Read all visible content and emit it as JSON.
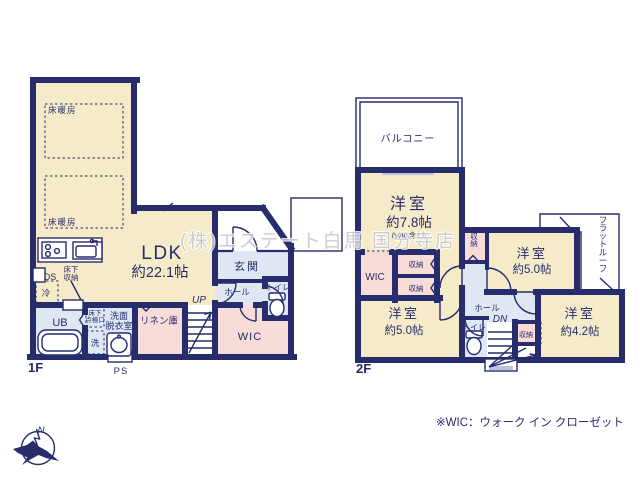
{
  "plan": {
    "floor1": {
      "floor_label": "1F",
      "ldk": {
        "name": "LDK",
        "size": "約22.1帖"
      },
      "floor_heating": "床暖房",
      "kitchen": {
        "ds": "DS",
        "underfloor_storage_l1": "床下",
        "underfloor_storage_l2": "収納",
        "fridge": "冷"
      },
      "bath": {
        "ub": "UB",
        "washer": "洗",
        "inspection_l1": "床下",
        "inspection_l2": "点検口"
      },
      "washroom": {
        "l1": "洗面",
        "l2": "脱衣室"
      },
      "linen": "リネン庫",
      "stairs_up": "UP",
      "hall": "ホール",
      "entrance": "玄関",
      "toilet": "トイレ",
      "wic": "WIC",
      "ps": "PS"
    },
    "floor2": {
      "floor_label": "2F",
      "balcony": "バルコニー",
      "room_78": {
        "name": "洋室",
        "size": "約7.8帖",
        "note": "(WIC含む)"
      },
      "room_50a": {
        "name": "洋室",
        "size": "約5.0帖"
      },
      "room_50b": {
        "name": "洋室",
        "size": "約5.0帖"
      },
      "room_42": {
        "name": "洋室",
        "size": "約4.2帖"
      },
      "wic": "WIC",
      "storage": "収納",
      "flat_roof": "フラットルーフ",
      "hall": "ホール",
      "stairs_down": "DN",
      "toilet": "トイレ"
    }
  },
  "watermark": "(株)エステート白馬 国分寺店",
  "legend": "※WIC：ウォーク イン クローゼット",
  "compass": {
    "north": "N"
  },
  "colors": {
    "wall": "#272c6d",
    "room_cream": "#f6ebc9",
    "room_pink": "#f8dcd7",
    "room_lavender": "#dfe7f3",
    "window": "#bcc3dc",
    "watermark": "#c5c5cb"
  }
}
